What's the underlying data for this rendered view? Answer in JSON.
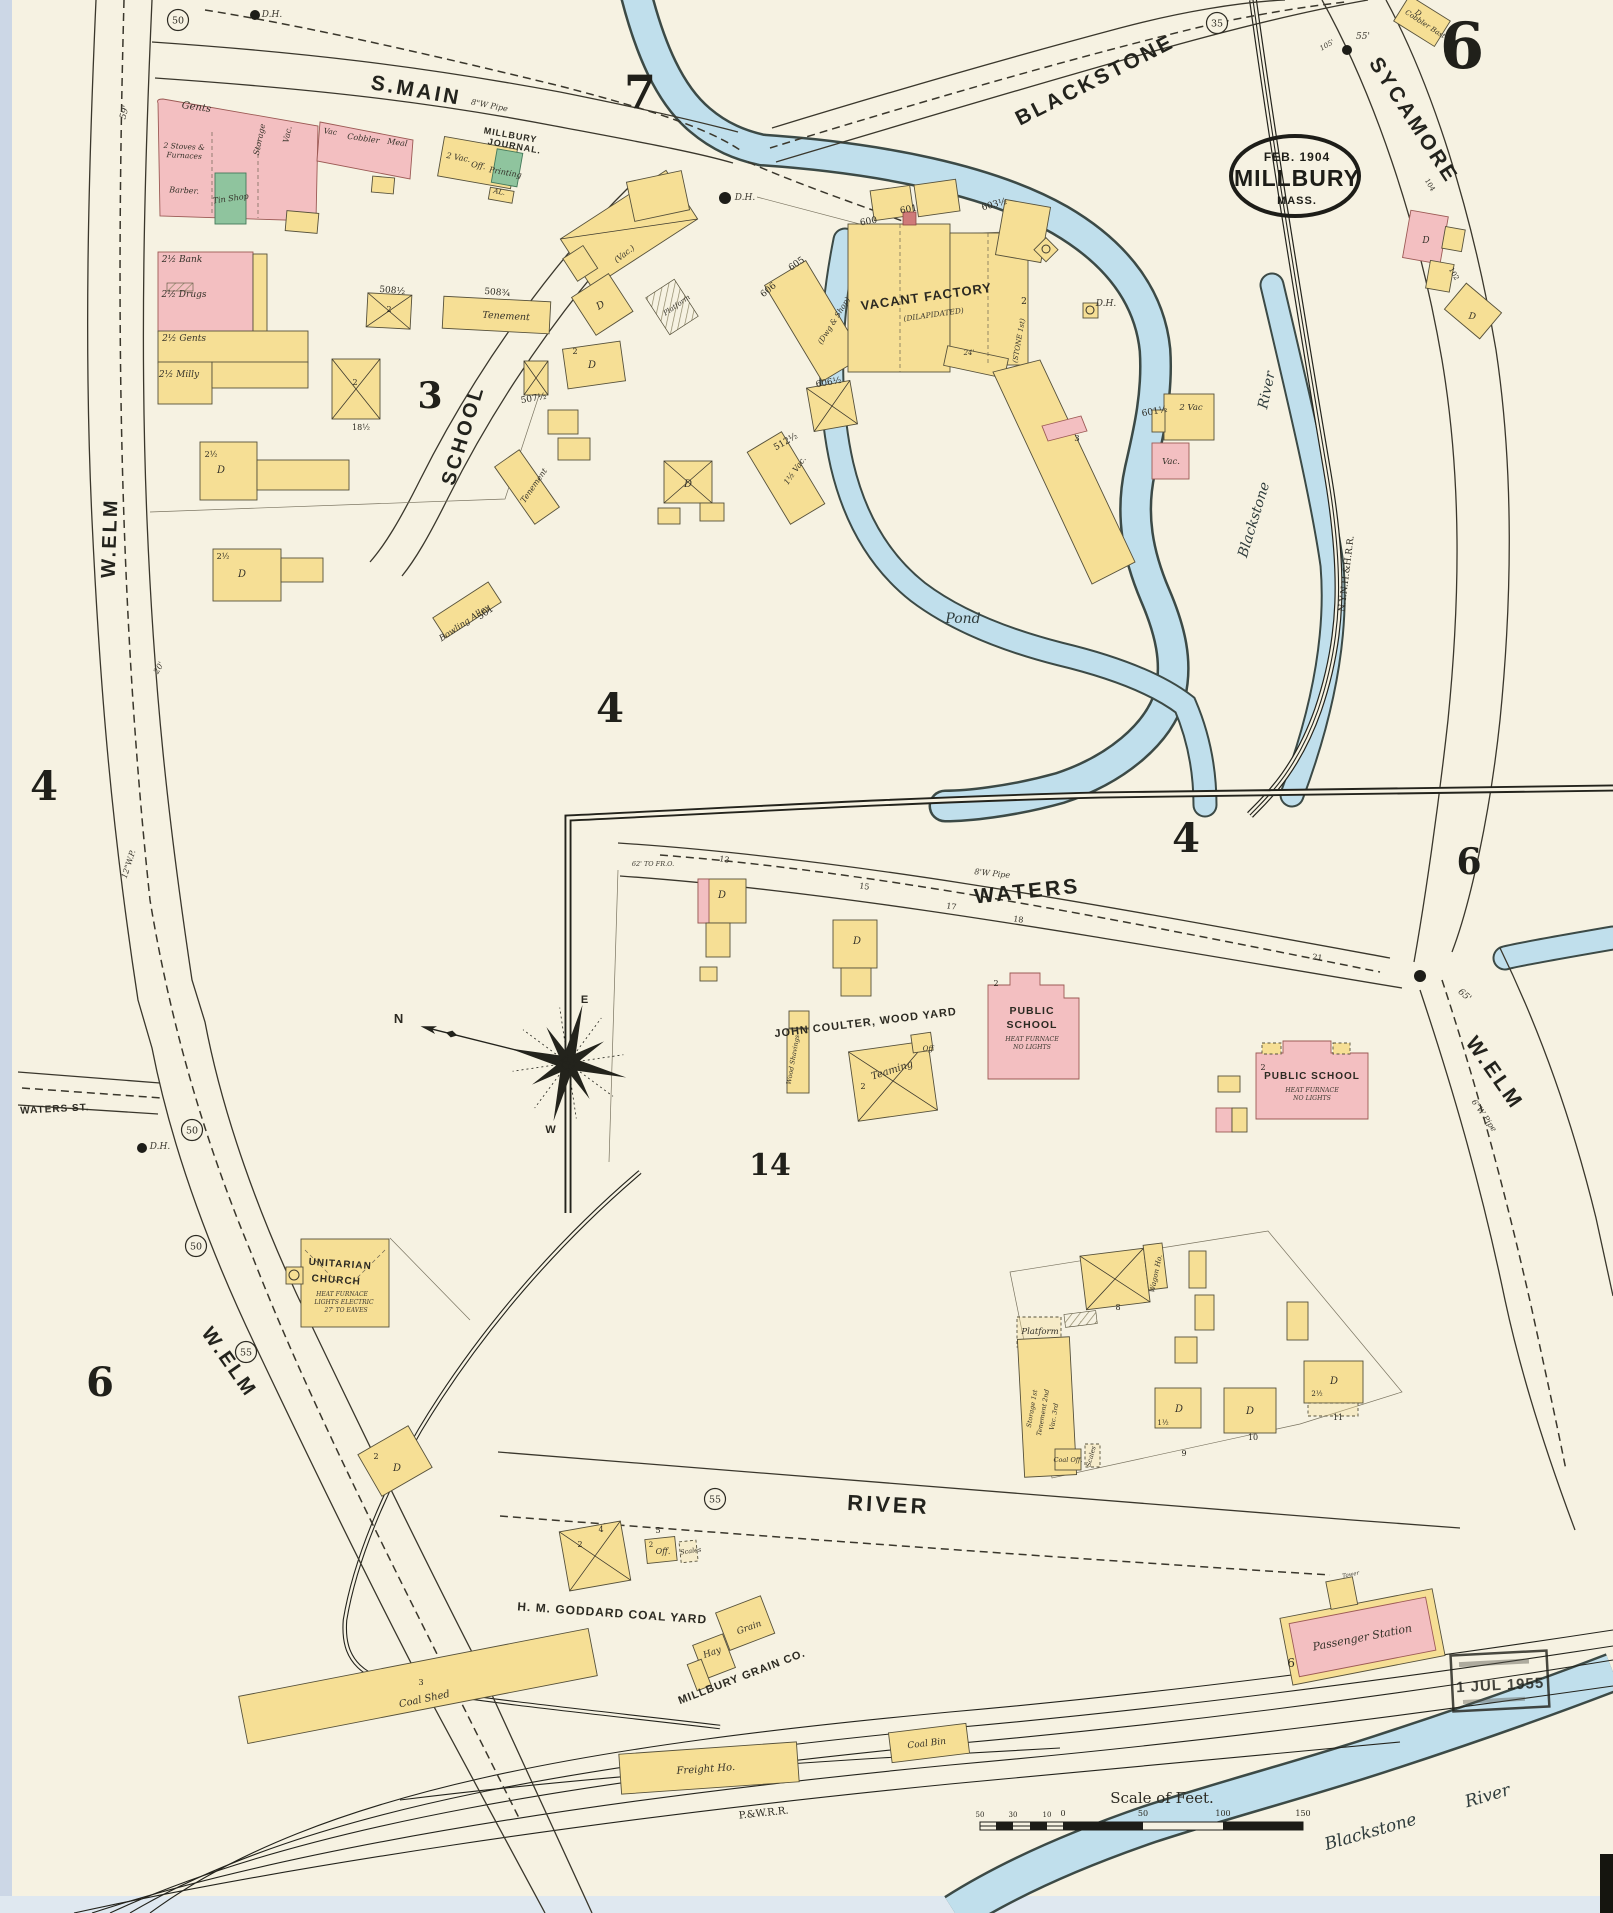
{
  "page": {
    "sheet_number": "6",
    "stamp": {
      "date": "FEB. 1904",
      "city": "MILLBURY",
      "state": "MASS."
    },
    "received_stamp": "1 JUL 1955",
    "scale_title": "Scale of Feet.",
    "compass": {
      "n": "N",
      "e": "E",
      "w": "W"
    }
  },
  "colors": {
    "paper": "#f6f2e2",
    "frame_yellow": "#f6df95",
    "brick_pink": "#f3bfc1",
    "special_green": "#8fc49e",
    "water_blue": "#c0dfec",
    "ink": "#23231c"
  },
  "labels": [
    {
      "t": "S.MAIN",
      "x": 415,
      "y": 97,
      "r": 10,
      "s": 21,
      "f": "st",
      "n": "street-label-s-main"
    },
    {
      "t": "BLACKSTONE",
      "x": 1098,
      "y": 86,
      "r": -27,
      "s": 21,
      "f": "st",
      "n": "street-label-blackstone"
    },
    {
      "t": "SYCAMORE",
      "x": 1408,
      "y": 124,
      "r": 57,
      "s": 21,
      "f": "st",
      "n": "street-label-sycamore"
    },
    {
      "t": "W.ELM",
      "x": 116,
      "y": 538,
      "r": -88,
      "s": 20,
      "f": "st",
      "n": "street-label-w-elm-upper"
    },
    {
      "t": "W.ELM",
      "x": 224,
      "y": 1366,
      "r": 55,
      "s": 20,
      "f": "st",
      "n": "street-label-w-elm-lower"
    },
    {
      "t": "W.ELM",
      "x": 1489,
      "y": 1077,
      "r": 55,
      "s": 21,
      "f": "st",
      "n": "street-label-w-elm-east"
    },
    {
      "t": "SCHOOL",
      "x": 469,
      "y": 437,
      "r": -73,
      "s": 20,
      "f": "st",
      "n": "street-label-school"
    },
    {
      "t": "WATERS",
      "x": 1028,
      "y": 898,
      "r": -6,
      "s": 21,
      "f": "st",
      "n": "street-label-waters"
    },
    {
      "t": "RIVER",
      "x": 888,
      "y": 1512,
      "r": 3,
      "s": 22,
      "f": "st",
      "n": "street-label-river"
    },
    {
      "t": "WATERS ST.",
      "x": 55,
      "y": 1112,
      "r": -3,
      "s": 10,
      "f": "cap",
      "n": "street-label-waters-st"
    },
    {
      "t": "N.Y.N.H.&H.R.R.",
      "x": 1349,
      "y": 574,
      "r": -83,
      "s": 9,
      "f": "rr",
      "n": "railroad-label-nynh"
    },
    {
      "t": "P.&W.R.R.",
      "x": 764,
      "y": 1816,
      "r": -6,
      "s": 10,
      "f": "rr",
      "n": "railroad-label-pw"
    },
    {
      "t": "H. M. GODDARD COAL YARD",
      "x": 612,
      "y": 1617,
      "r": 4,
      "s": 12,
      "f": "cap",
      "n": "label-goddard-coal-yard"
    },
    {
      "t": "JOHN COULTER, WOOD YARD",
      "x": 866,
      "y": 1026,
      "r": -7,
      "s": 11,
      "f": "cap",
      "n": "label-coulter-wood-yard"
    },
    {
      "t": "MILLBURY GRAIN CO.",
      "x": 743,
      "y": 1680,
      "r": -21,
      "s": 11,
      "f": "cap",
      "n": "label-millbury-grain-co"
    },
    {
      "t": "MILLBURY",
      "x": 510,
      "y": 138,
      "r": 10,
      "s": 9,
      "f": "cap",
      "n": "label-millbury-journal"
    },
    {
      "t": "JOURNAL.",
      "x": 514,
      "y": 149,
      "r": 10,
      "s": 9,
      "f": "cap",
      "n": "label-millbury-journal"
    },
    {
      "t": "Pond",
      "x": 963,
      "y": 623,
      "s": 14,
      "f": "wtr",
      "n": "label-pond"
    },
    {
      "t": "Blackstone",
      "x": 1258,
      "y": 521,
      "r": -73,
      "s": 14,
      "f": "wtr",
      "n": "label-blackstone-river"
    },
    {
      "t": "River",
      "x": 1271,
      "y": 391,
      "r": -78,
      "s": 14,
      "f": "wtr",
      "n": "label-blackstone-river"
    },
    {
      "t": "Blackstone",
      "x": 1372,
      "y": 1837,
      "r": -16,
      "s": 17,
      "f": "wtr",
      "n": "label-blackstone-river-south"
    },
    {
      "t": "River",
      "x": 1489,
      "y": 1801,
      "r": -16,
      "s": 17,
      "f": "wtr",
      "n": "label-blackstone-river-south"
    },
    {
      "t": "7",
      "x": 640,
      "y": 108,
      "s": 46,
      "f": "big",
      "n": "block-number-7"
    },
    {
      "t": "3",
      "x": 430,
      "y": 408,
      "s": 36,
      "f": "big",
      "n": "block-number-3"
    },
    {
      "t": "4",
      "x": 610,
      "y": 722,
      "s": 40,
      "f": "big",
      "n": "block-number-4"
    },
    {
      "t": "4",
      "x": 44,
      "y": 800,
      "s": 40,
      "f": "big",
      "n": "sheet-number-4-left"
    },
    {
      "t": "4",
      "x": 1186,
      "y": 852,
      "s": 40,
      "f": "big",
      "n": "sheet-number-4-inset"
    },
    {
      "t": "6",
      "x": 1469,
      "y": 874,
      "s": 36,
      "f": "big",
      "n": "sheet-number-6-east"
    },
    {
      "t": "6",
      "x": 100,
      "y": 1396,
      "s": 40,
      "f": "big",
      "n": "sheet-number-6-left"
    },
    {
      "t": "14",
      "x": 770,
      "y": 1175,
      "s": 30,
      "f": "big",
      "n": "block-number-14"
    },
    {
      "t": "50",
      "x": 178,
      "y": 20,
      "f": "circ",
      "n": "circled-50"
    },
    {
      "t": "35",
      "x": 1217,
      "y": 23,
      "f": "circ",
      "n": "circled-35"
    },
    {
      "t": "50",
      "x": 192,
      "y": 1130,
      "f": "circ",
      "n": "circled-50"
    },
    {
      "t": "50",
      "x": 196,
      "y": 1246,
      "f": "circ",
      "n": "circled-50"
    },
    {
      "t": "55",
      "x": 246,
      "y": 1352,
      "f": "circ",
      "n": "circled-55"
    },
    {
      "t": "55",
      "x": 715,
      "y": 1499,
      "f": "circ",
      "n": "circled-55"
    },
    {
      "t": "D.H.",
      "x": 272,
      "y": 17,
      "s": 9,
      "f": "tiny",
      "n": "hydrant-label"
    },
    {
      "t": "D.H.",
      "x": 745,
      "y": 200,
      "s": 9,
      "f": "tiny",
      "n": "hydrant-label"
    },
    {
      "t": "D.H.",
      "x": 1106,
      "y": 306,
      "s": 9,
      "f": "tiny",
      "n": "hydrant-label"
    },
    {
      "t": "D.H.",
      "x": 160,
      "y": 1149,
      "s": 9,
      "f": "tiny",
      "n": "hydrant-label"
    },
    {
      "t": "55'",
      "x": 1363,
      "y": 39,
      "s": 9,
      "f": "tiny"
    },
    {
      "t": "105'",
      "x": 1328,
      "y": 47,
      "r": -30,
      "s": 7,
      "f": "tiny"
    },
    {
      "t": "59'",
      "x": 127,
      "y": 113,
      "r": -75,
      "s": 9,
      "f": "tiny"
    },
    {
      "t": "65'",
      "x": 1463,
      "y": 997,
      "r": 40,
      "s": 9,
      "f": "tiny"
    },
    {
      "t": "62' TO FR.O.",
      "x": 653,
      "y": 866,
      "s": 6.5,
      "f": "tiny"
    },
    {
      "t": "8'W Pipe",
      "x": 992,
      "y": 876,
      "r": 6,
      "s": 8,
      "f": "tiny"
    },
    {
      "t": "8\"W Pipe",
      "x": 489,
      "y": 108,
      "r": 11,
      "s": 8,
      "f": "tiny"
    },
    {
      "t": "12\"W.P.",
      "x": 131,
      "y": 865,
      "r": -72,
      "s": 8,
      "f": "tiny"
    },
    {
      "t": "6\"W Pipe",
      "x": 1482,
      "y": 1117,
      "r": 55,
      "s": 8,
      "f": "tiny"
    },
    {
      "t": "20'",
      "x": 161,
      "y": 669,
      "r": -60,
      "s": 8,
      "f": "tiny"
    },
    {
      "t": "600",
      "x": 869,
      "y": 224,
      "r": -10,
      "s": 9,
      "f": "num"
    },
    {
      "t": "601",
      "x": 909,
      "y": 212,
      "r": -10,
      "s": 9,
      "f": "num"
    },
    {
      "t": "603½",
      "x": 995,
      "y": 207,
      "r": -15,
      "s": 9,
      "f": "num"
    },
    {
      "t": "605",
      "x": 798,
      "y": 266,
      "r": -35,
      "s": 9,
      "f": "num"
    },
    {
      "t": "606",
      "x": 770,
      "y": 292,
      "r": -40,
      "s": 9,
      "f": "num"
    },
    {
      "t": "606½",
      "x": 829,
      "y": 385,
      "r": -10,
      "s": 9,
      "f": "num"
    },
    {
      "t": "512½",
      "x": 787,
      "y": 444,
      "r": -30,
      "s": 9,
      "f": "num"
    },
    {
      "t": "601½",
      "x": 1155,
      "y": 414,
      "r": -10,
      "s": 9,
      "f": "num"
    },
    {
      "t": "508½",
      "x": 392,
      "y": 293,
      "r": 5,
      "s": 9,
      "f": "num"
    },
    {
      "t": "508¾",
      "x": 497,
      "y": 295,
      "r": 5,
      "s": 9,
      "f": "num"
    },
    {
      "t": "507½",
      "x": 534,
      "y": 401,
      "r": -10,
      "s": 9,
      "f": "num"
    },
    {
      "t": "501",
      "x": 487,
      "y": 615,
      "r": -35,
      "s": 9,
      "f": "num"
    },
    {
      "t": "18½",
      "x": 361,
      "y": 430,
      "s": 8,
      "f": "num"
    },
    {
      "t": "13",
      "x": 724,
      "y": 862,
      "r": 8,
      "s": 8,
      "f": "num"
    },
    {
      "t": "15",
      "x": 864,
      "y": 889,
      "r": 8,
      "s": 8,
      "f": "num"
    },
    {
      "t": "17",
      "x": 951,
      "y": 909,
      "r": 8,
      "s": 8,
      "f": "num"
    },
    {
      "t": "18",
      "x": 1018,
      "y": 922,
      "r": 8,
      "s": 8,
      "f": "num"
    },
    {
      "t": "21",
      "x": 1317,
      "y": 960,
      "r": 8,
      "s": 8,
      "f": "num"
    },
    {
      "t": "8",
      "x": 1118,
      "y": 1310,
      "s": 8,
      "f": "num"
    },
    {
      "t": "9",
      "x": 1184,
      "y": 1456,
      "s": 8,
      "f": "num"
    },
    {
      "t": "10",
      "x": 1253,
      "y": 1440,
      "s": 8,
      "f": "num"
    },
    {
      "t": "11",
      "x": 1338,
      "y": 1420,
      "s": 8,
      "f": "num"
    },
    {
      "t": "104",
      "x": 1428,
      "y": 186,
      "r": 60,
      "s": 7,
      "f": "num"
    },
    {
      "t": "102",
      "x": 1452,
      "y": 275,
      "r": 60,
      "s": 7,
      "f": "num"
    },
    {
      "t": "Gents",
      "x": 196,
      "y": 110,
      "r": 8,
      "s": 10
    },
    {
      "t": "2 Stoves &",
      "x": 184,
      "y": 149,
      "r": 3,
      "s": 7.5
    },
    {
      "t": "Furnaces",
      "x": 184,
      "y": 158,
      "r": 3,
      "s": 7.5
    },
    {
      "t": "Barber.",
      "x": 184,
      "y": 193,
      "r": 3,
      "s": 8
    },
    {
      "t": "Tin Shop",
      "x": 231,
      "y": 201,
      "r": -8,
      "s": 8
    },
    {
      "t": "Storage",
      "x": 262,
      "y": 140,
      "r": -78,
      "s": 8
    },
    {
      "t": "Vac.",
      "x": 290,
      "y": 135,
      "r": -78,
      "s": 8
    },
    {
      "t": "Vac",
      "x": 330,
      "y": 134,
      "r": 8,
      "s": 7.5
    },
    {
      "t": "Cobbler",
      "x": 363,
      "y": 141,
      "r": 8,
      "s": 8
    },
    {
      "t": "Meal",
      "x": 397,
      "y": 145,
      "r": 8,
      "s": 8
    },
    {
      "t": "2 Vac.",
      "x": 458,
      "y": 160,
      "r": 10,
      "s": 8
    },
    {
      "t": "Off.",
      "x": 478,
      "y": 168,
      "r": 10,
      "s": 8
    },
    {
      "t": "Printing",
      "x": 505,
      "y": 175,
      "r": 10,
      "s": 8
    },
    {
      "t": "AL.",
      "x": 499,
      "y": 194,
      "r": 10,
      "s": 7
    },
    {
      "t": "2½ Bank",
      "x": 182,
      "y": 262,
      "s": 9
    },
    {
      "t": "2½ Drugs",
      "x": 184,
      "y": 297,
      "s": 9
    },
    {
      "t": "2½ Gents",
      "x": 184,
      "y": 341,
      "s": 9
    },
    {
      "t": "2½ Milly",
      "x": 179,
      "y": 377,
      "s": 9
    },
    {
      "t": "Tenement",
      "x": 506,
      "y": 319,
      "r": 3,
      "s": 9.5
    },
    {
      "t": "Tenement",
      "x": 536,
      "y": 487,
      "r": -55,
      "s": 8
    },
    {
      "t": "Bowling Alley",
      "x": 466,
      "y": 625,
      "r": -34,
      "s": 8.5
    },
    {
      "t": "(Vac.)",
      "x": 626,
      "y": 256,
      "r": -38,
      "s": 8
    },
    {
      "t": "2½",
      "x": 211,
      "y": 457,
      "s": 8,
      "f": "num"
    },
    {
      "t": "D",
      "x": 221,
      "y": 473,
      "s": 10
    },
    {
      "t": "2½",
      "x": 223,
      "y": 559,
      "s": 8,
      "f": "num"
    },
    {
      "t": "D",
      "x": 242,
      "y": 577,
      "s": 10
    },
    {
      "t": "2",
      "x": 575,
      "y": 354,
      "s": 8,
      "f": "num"
    },
    {
      "t": "D",
      "x": 592,
      "y": 368,
      "s": 10
    },
    {
      "t": "D",
      "x": 602,
      "y": 308,
      "r": -30,
      "s": 10
    },
    {
      "t": "Platform",
      "x": 678,
      "y": 307,
      "r": -35,
      "s": 7
    },
    {
      "t": "D",
      "x": 688,
      "y": 487,
      "s": 10
    },
    {
      "t": "2",
      "x": 389,
      "y": 312,
      "s": 8,
      "f": "num"
    },
    {
      "t": "2",
      "x": 355,
      "y": 385,
      "s": 8,
      "f": "num"
    },
    {
      "t": "VACANT FACTORY",
      "x": 927,
      "y": 301,
      "r": -8,
      "s": 13,
      "f": "cap",
      "n": "label-vacant-factory"
    },
    {
      "t": "(DILAPIDATED)",
      "x": 934,
      "y": 317,
      "r": -8,
      "s": 7.5,
      "f": "tiny"
    },
    {
      "t": "(Dwg & Shop)",
      "x": 836,
      "y": 322,
      "r": -58,
      "s": 7.5
    },
    {
      "t": "(STONE 1st)",
      "x": 1021,
      "y": 341,
      "r": -80,
      "s": 7
    },
    {
      "t": "2",
      "x": 1024,
      "y": 304,
      "s": 9,
      "f": "num"
    },
    {
      "t": "24'",
      "x": 969,
      "y": 355,
      "s": 7,
      "f": "tiny"
    },
    {
      "t": "3",
      "x": 1077,
      "y": 441,
      "s": 8.5,
      "f": "num"
    },
    {
      "t": "1½ Vac.",
      "x": 797,
      "y": 472,
      "r": -55,
      "s": 8
    },
    {
      "t": "2 Vac",
      "x": 1191,
      "y": 410,
      "s": 8.5
    },
    {
      "t": "Vac.",
      "x": 1171,
      "y": 464,
      "s": 8.5
    },
    {
      "t": "D",
      "x": 722,
      "y": 898,
      "s": 10
    },
    {
      "t": "D",
      "x": 857,
      "y": 944,
      "s": 10
    },
    {
      "t": "PUBLIC",
      "x": 1032,
      "y": 1014,
      "s": 10.5,
      "f": "cap",
      "n": "label-public-school-1"
    },
    {
      "t": "SCHOOL",
      "x": 1032,
      "y": 1028,
      "s": 10.5,
      "f": "cap",
      "n": "label-public-school-1"
    },
    {
      "t": "HEAT FURNACE",
      "x": 1032,
      "y": 1041,
      "s": 6.2,
      "f": "tiny"
    },
    {
      "t": "NO LIGHTS",
      "x": 1032,
      "y": 1049,
      "s": 6.2,
      "f": "tiny"
    },
    {
      "t": "2",
      "x": 996,
      "y": 986,
      "s": 8,
      "f": "num"
    },
    {
      "t": "PUBLIC SCHOOL",
      "x": 1312,
      "y": 1079,
      "s": 10,
      "f": "cap",
      "n": "label-public-school-2"
    },
    {
      "t": "HEAT FURNACE",
      "x": 1312,
      "y": 1092,
      "s": 6.2,
      "f": "tiny"
    },
    {
      "t": "NO LIGHTS",
      "x": 1312,
      "y": 1100,
      "s": 6.2,
      "f": "tiny"
    },
    {
      "t": "2",
      "x": 1263,
      "y": 1070,
      "s": 8,
      "f": "num"
    },
    {
      "t": "Wood Shavings",
      "x": 795,
      "y": 1060,
      "r": -80,
      "s": 6.5
    },
    {
      "t": "Teaming",
      "x": 893,
      "y": 1073,
      "r": -18,
      "s": 10
    },
    {
      "t": "Off",
      "x": 928,
      "y": 1051,
      "s": 7
    },
    {
      "t": "2",
      "x": 863,
      "y": 1089,
      "s": 8,
      "f": "num"
    },
    {
      "t": "UNITARIAN",
      "x": 340,
      "y": 1267,
      "r": 4,
      "s": 10,
      "f": "cap",
      "n": "label-unitarian-church"
    },
    {
      "t": "CHURCH",
      "x": 336,
      "y": 1283,
      "r": 4,
      "s": 10,
      "f": "cap",
      "n": "label-unitarian-church"
    },
    {
      "t": "HEAT FURNACE",
      "x": 342,
      "y": 1296,
      "s": 6,
      "f": "tiny"
    },
    {
      "t": "LIGHTS ELECTRIC",
      "x": 344,
      "y": 1304,
      "s": 6,
      "f": "tiny"
    },
    {
      "t": "27' TO EAVES",
      "x": 346,
      "y": 1312,
      "s": 6,
      "f": "tiny"
    },
    {
      "t": "Wagon Ho.",
      "x": 1158,
      "y": 1274,
      "r": -78,
      "s": 7
    },
    {
      "t": "Platform",
      "x": 1040,
      "y": 1334,
      "s": 8.5
    },
    {
      "t": "Storage 1st",
      "x": 1034,
      "y": 1409,
      "r": -80,
      "s": 6.5
    },
    {
      "t": "Tenement 2nd",
      "x": 1045,
      "y": 1413,
      "r": -80,
      "s": 6.5
    },
    {
      "t": "Vac. 3rd",
      "x": 1056,
      "y": 1417,
      "r": -80,
      "s": 6.5
    },
    {
      "t": "Coal Off.",
      "x": 1068,
      "y": 1462,
      "s": 6.5
    },
    {
      "t": "Scales",
      "x": 1093,
      "y": 1457,
      "r": -75,
      "s": 6.5
    },
    {
      "t": "1½",
      "x": 1163,
      "y": 1425,
      "s": 7,
      "f": "num"
    },
    {
      "t": "D",
      "x": 1179,
      "y": 1412,
      "s": 10
    },
    {
      "t": "D",
      "x": 1250,
      "y": 1414,
      "s": 10
    },
    {
      "t": "2½",
      "x": 1317,
      "y": 1396,
      "s": 7,
      "f": "num"
    },
    {
      "t": "D",
      "x": 1334,
      "y": 1384,
      "s": 10
    },
    {
      "t": "2",
      "x": 376,
      "y": 1459,
      "s": 8,
      "f": "num"
    },
    {
      "t": "D",
      "x": 397,
      "y": 1471,
      "s": 10
    },
    {
      "t": "Hay",
      "x": 713,
      "y": 1655,
      "r": -20,
      "s": 9
    },
    {
      "t": "Grain",
      "x": 750,
      "y": 1630,
      "r": -20,
      "s": 9
    },
    {
      "t": "Coal Shed",
      "x": 425,
      "y": 1702,
      "r": -12,
      "s": 10
    },
    {
      "t": "3",
      "x": 421,
      "y": 1685,
      "s": 8,
      "f": "num"
    },
    {
      "t": "5",
      "x": 658,
      "y": 1533,
      "s": 8,
      "f": "num"
    },
    {
      "t": "2",
      "x": 651,
      "y": 1547,
      "s": 7,
      "f": "num"
    },
    {
      "t": "Off.",
      "x": 663,
      "y": 1554,
      "s": 8
    },
    {
      "t": "Scales",
      "x": 691,
      "y": 1553,
      "r": -8,
      "s": 6.5
    },
    {
      "t": "2",
      "x": 580,
      "y": 1547,
      "s": 8,
      "f": "num"
    },
    {
      "t": "4",
      "x": 601,
      "y": 1532,
      "s": 8,
      "f": "num"
    },
    {
      "t": "Freight Ho.",
      "x": 706,
      "y": 1772,
      "r": -4,
      "s": 10
    },
    {
      "t": "Coal Bin",
      "x": 927,
      "y": 1746,
      "r": -7,
      "s": 9
    },
    {
      "t": "Passenger Station",
      "x": 1363,
      "y": 1641,
      "r": -11,
      "s": 11,
      "n": "label-passenger-station"
    },
    {
      "t": "Tower",
      "x": 1351,
      "y": 1576,
      "r": -11,
      "s": 5.5,
      "f": "tiny"
    },
    {
      "t": "6",
      "x": 1291,
      "y": 1667,
      "s": 12,
      "f": "num"
    },
    {
      "t": "Cobbler Bast",
      "x": 1424,
      "y": 26,
      "r": 33,
      "s": 7
    },
    {
      "t": "D",
      "x": 1417,
      "y": 15,
      "r": 33,
      "s": 7.5
    },
    {
      "t": "D",
      "x": 1426,
      "y": 243,
      "s": 9
    },
    {
      "t": "D",
      "x": 1472,
      "y": 319,
      "r": 8,
      "s": 9
    },
    {
      "t": "N",
      "x": 399,
      "y": 1023,
      "s": 13,
      "f": "cap",
      "n": "compass-n"
    },
    {
      "t": "E",
      "x": 585,
      "y": 1003,
      "s": 11,
      "f": "cap",
      "n": "compass-e"
    },
    {
      "t": "W",
      "x": 551,
      "y": 1133,
      "s": 11,
      "f": "cap",
      "n": "compass-w"
    },
    {
      "t": "50",
      "x": 980,
      "y": 1817,
      "s": 7,
      "f": "num"
    },
    {
      "t": "30",
      "x": 1013,
      "y": 1817,
      "s": 7,
      "f": "num"
    },
    {
      "t": "10",
      "x": 1047,
      "y": 1817,
      "s": 7,
      "f": "num"
    },
    {
      "t": "0",
      "x": 1063,
      "y": 1816,
      "s": 8,
      "f": "num"
    },
    {
      "t": "50",
      "x": 1143,
      "y": 1816,
      "s": 8,
      "f": "num"
    },
    {
      "t": "100",
      "x": 1223,
      "y": 1816,
      "s": 8,
      "f": "num"
    },
    {
      "t": "150",
      "x": 1303,
      "y": 1816,
      "s": 8,
      "f": "num"
    }
  ]
}
